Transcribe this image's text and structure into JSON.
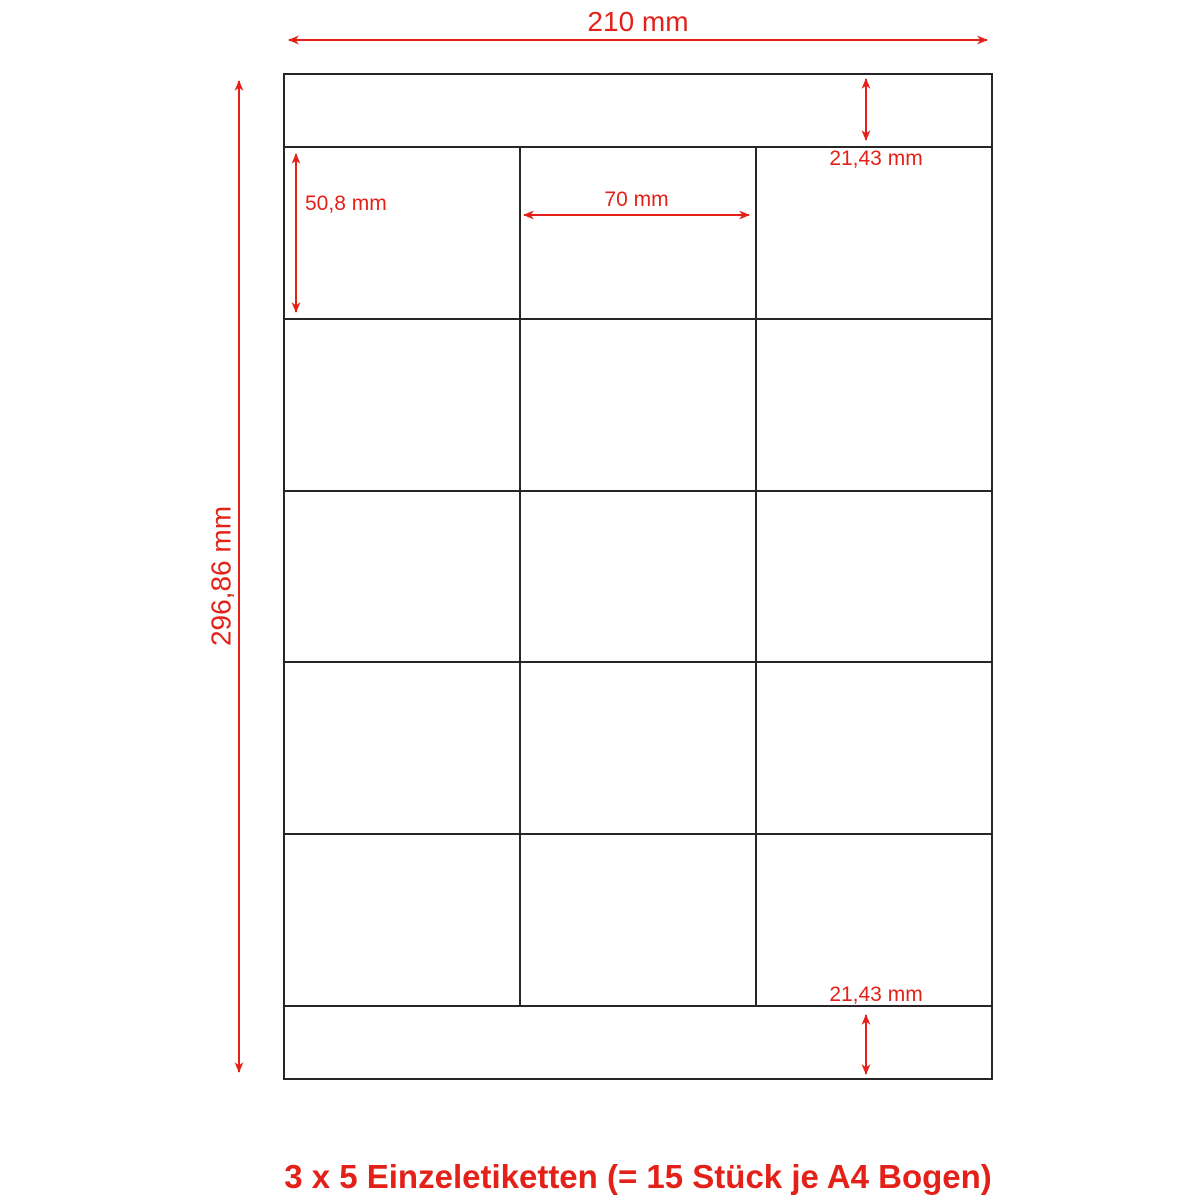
{
  "colors": {
    "dimension_red": "#e32119",
    "grid_line": "#262626",
    "background": "#ffffff"
  },
  "sheet": {
    "width_mm": 210,
    "height_mm": 296.86,
    "top_margin_mm": 21.43,
    "bottom_margin_mm": 21.43,
    "label_width_mm": 70,
    "label_height_mm": 50.8,
    "grid": {
      "columns": 3,
      "rows": 5,
      "labels_total": 15
    }
  },
  "dimensions": {
    "sheet_width_label": "210 mm",
    "sheet_height_label": "296,86 mm",
    "top_margin_label": "21,43 mm",
    "bottom_margin_label": "21,43 mm",
    "label_height_label": "50,8 mm",
    "label_width_label": "70 mm"
  },
  "caption": "3 x 5 Einzeletiketten (= 15 Stück je A4 Bogen)"
}
